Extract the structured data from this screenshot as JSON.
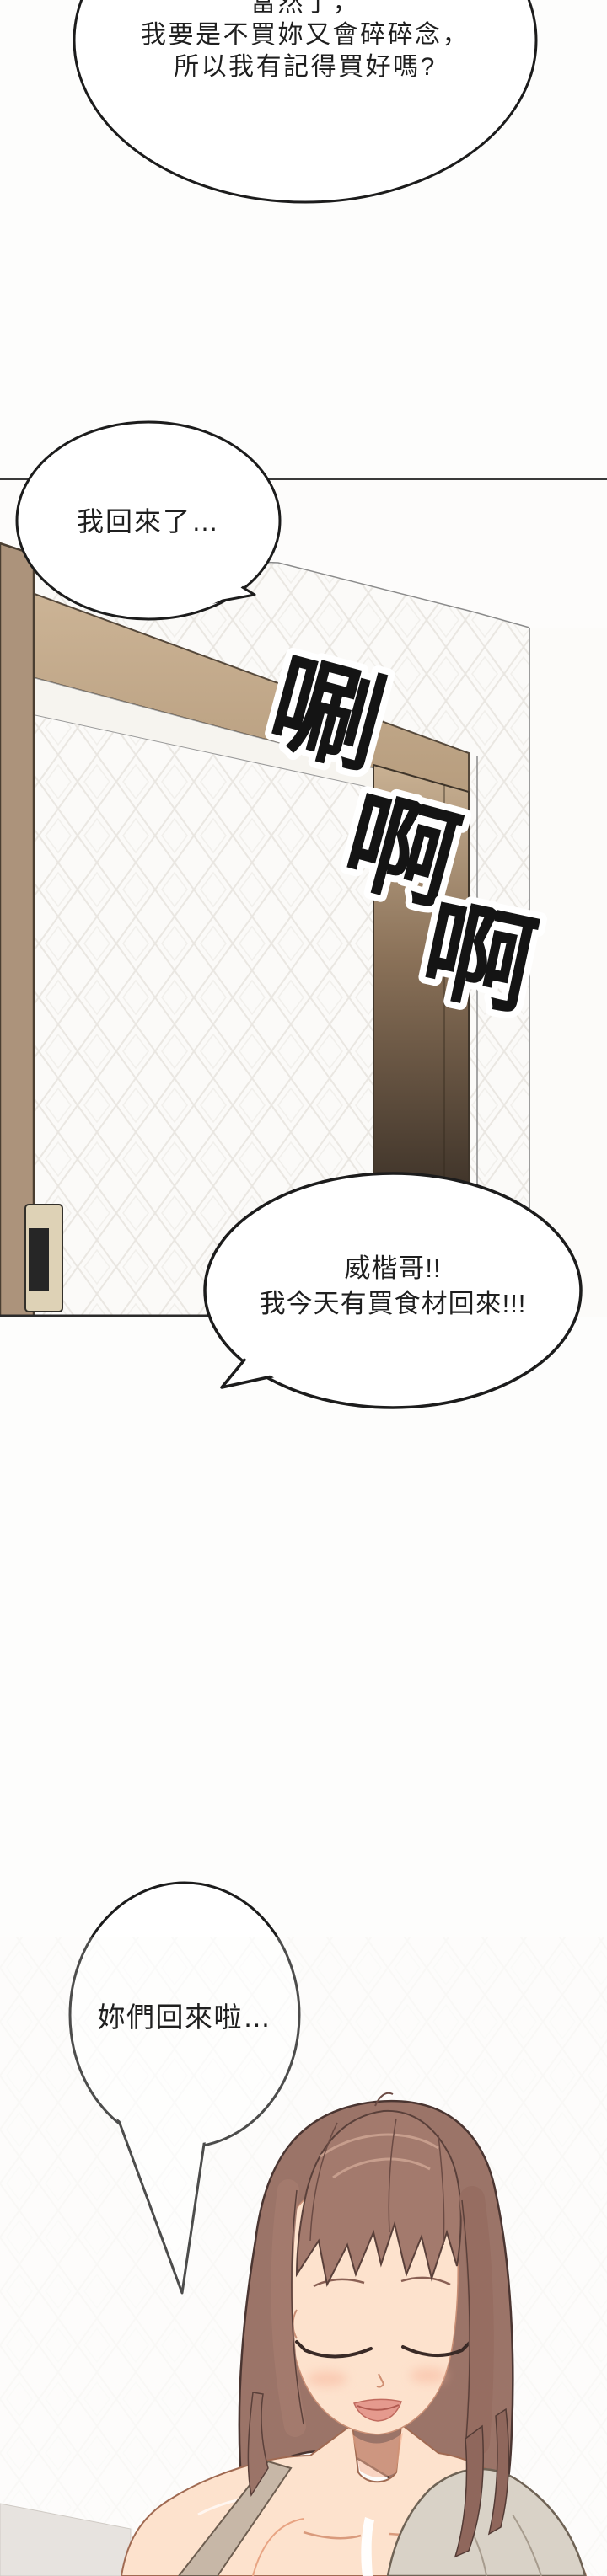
{
  "page": {
    "kind": "manhwa-comic-page",
    "background": "#fdfdfc"
  },
  "bubbles": {
    "b1": {
      "lines": [
        "當然了，",
        "我要是不買妳又會碎碎念，",
        "所以我有記得買好嗎?"
      ]
    },
    "b2": {
      "lines": [
        "我回來了…"
      ]
    },
    "b3": {
      "lines": [
        "威楷哥!!",
        "我今天有買食材回來!!!"
      ]
    },
    "b4": {
      "lines": [
        "妳們回來啦…"
      ]
    }
  },
  "sfx": {
    "chars": [
      "唰",
      "啊",
      "啊"
    ]
  },
  "scene": {
    "description": "apartment entry door opening",
    "colors": {
      "outline": "#1c1c1c",
      "door_wood": "#ac937b",
      "frame_beam_light": "#cdb597",
      "frame_beam_dark": "#b79d7e",
      "doorway_top": "#c9b193",
      "doorway_bottom": "#3d3228",
      "lock_plate": "#ded2b6",
      "wallpaper_line": "#eae7e2"
    }
  },
  "character": {
    "description": "smiling woman with closed eyes, shoulder-length brown hair, bare shoulders with strap and draped top",
    "colors": {
      "hair": "#9b7468",
      "hair_dark": "#5a403a",
      "hair_highlight": "#cfa795",
      "skin": "#fde2cd",
      "blush": "#f8b79d",
      "lips": "#e59a8e",
      "garment": "#d9d2c7",
      "strap": "#c7b7a7"
    }
  }
}
